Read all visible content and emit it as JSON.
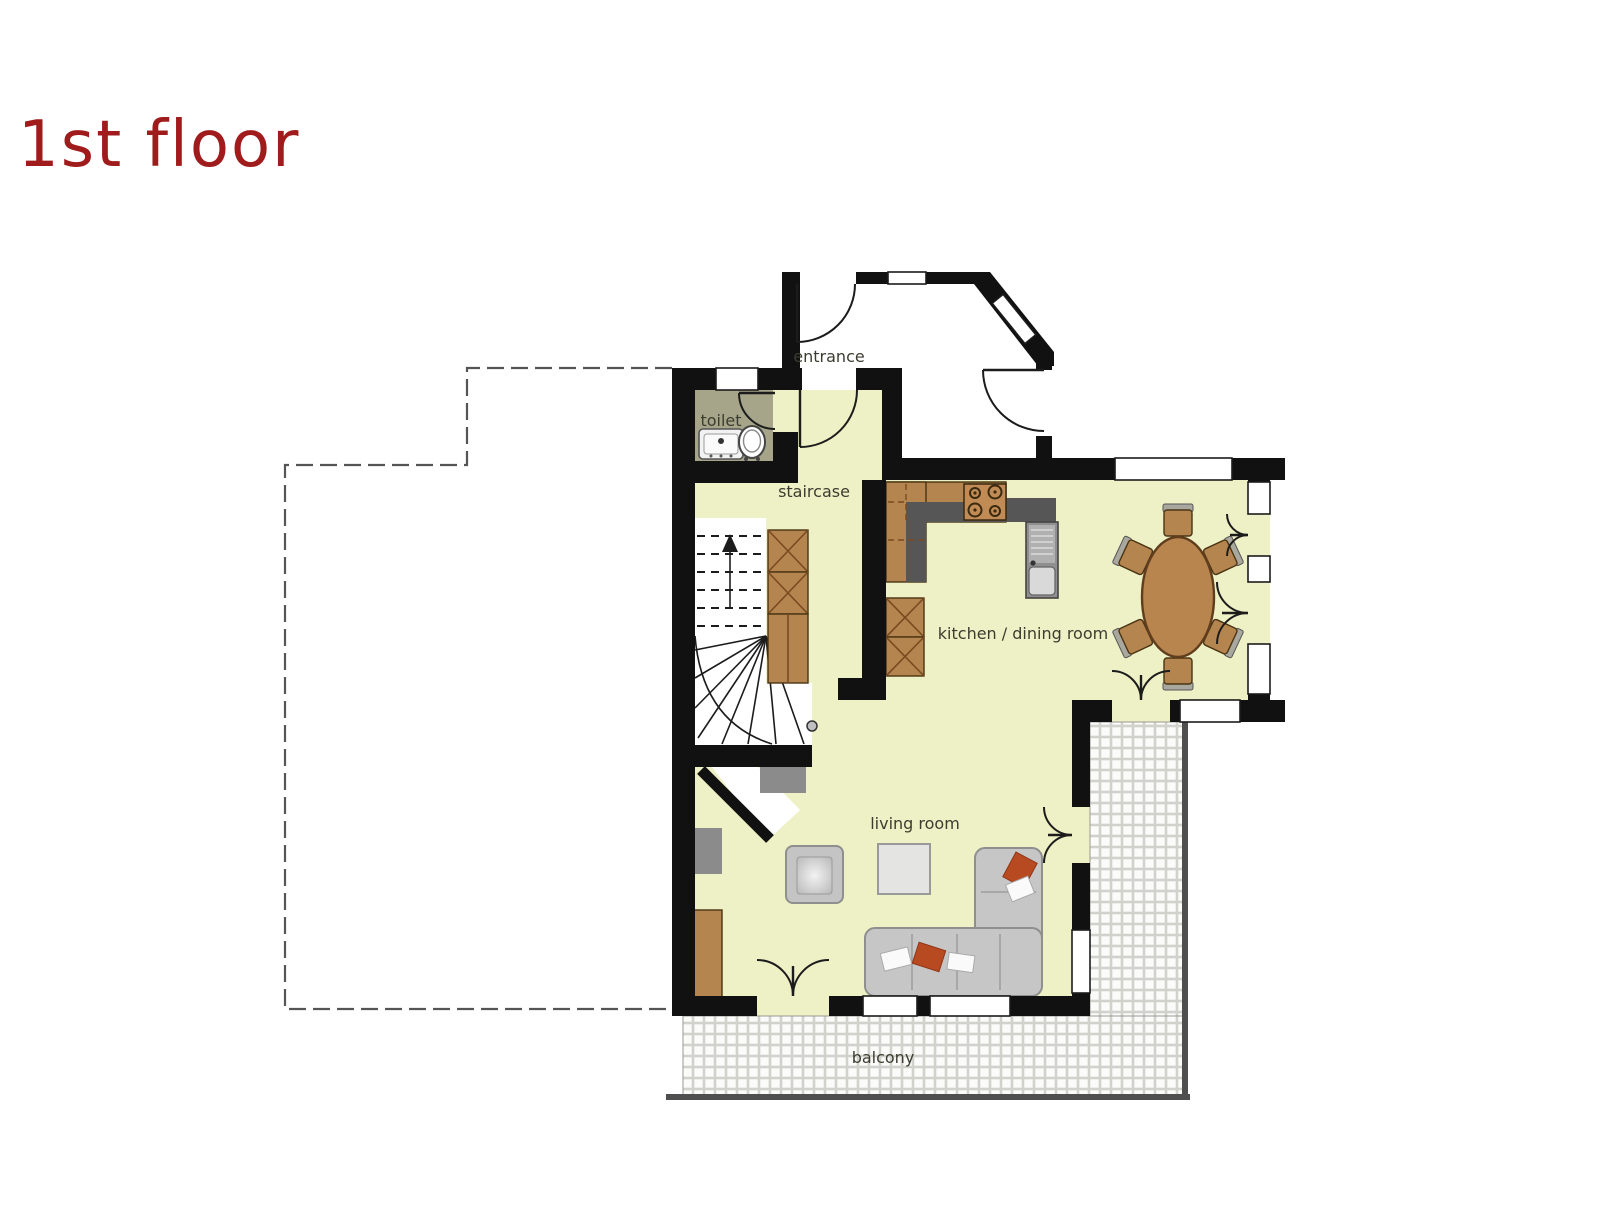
{
  "title": "1st floor",
  "rooms": {
    "entrance": "entrance",
    "toilet": "toilet",
    "staircase": "staircase",
    "kitchen_dining": "kitchen / dining room",
    "living_room": "living room",
    "balcony": "balcony"
  },
  "colors": {
    "accent_title": "#a01c1c",
    "wall": "#111111",
    "floor_main": "#eef0c5",
    "floor_toilet": "#a6a58a",
    "floor_outdoor": "#ffffff",
    "tile_grout": "#d2d2cc",
    "wood": "#b5854f",
    "wood_dark": "#7a4a20",
    "counter_gray": "#565656",
    "sofa_gray": "#c6c6c6",
    "pillow_red": "#b84a22",
    "label_text": "#3c3c30",
    "outline_gray": "#555555",
    "understair_gray": "#8b8b8b"
  }
}
